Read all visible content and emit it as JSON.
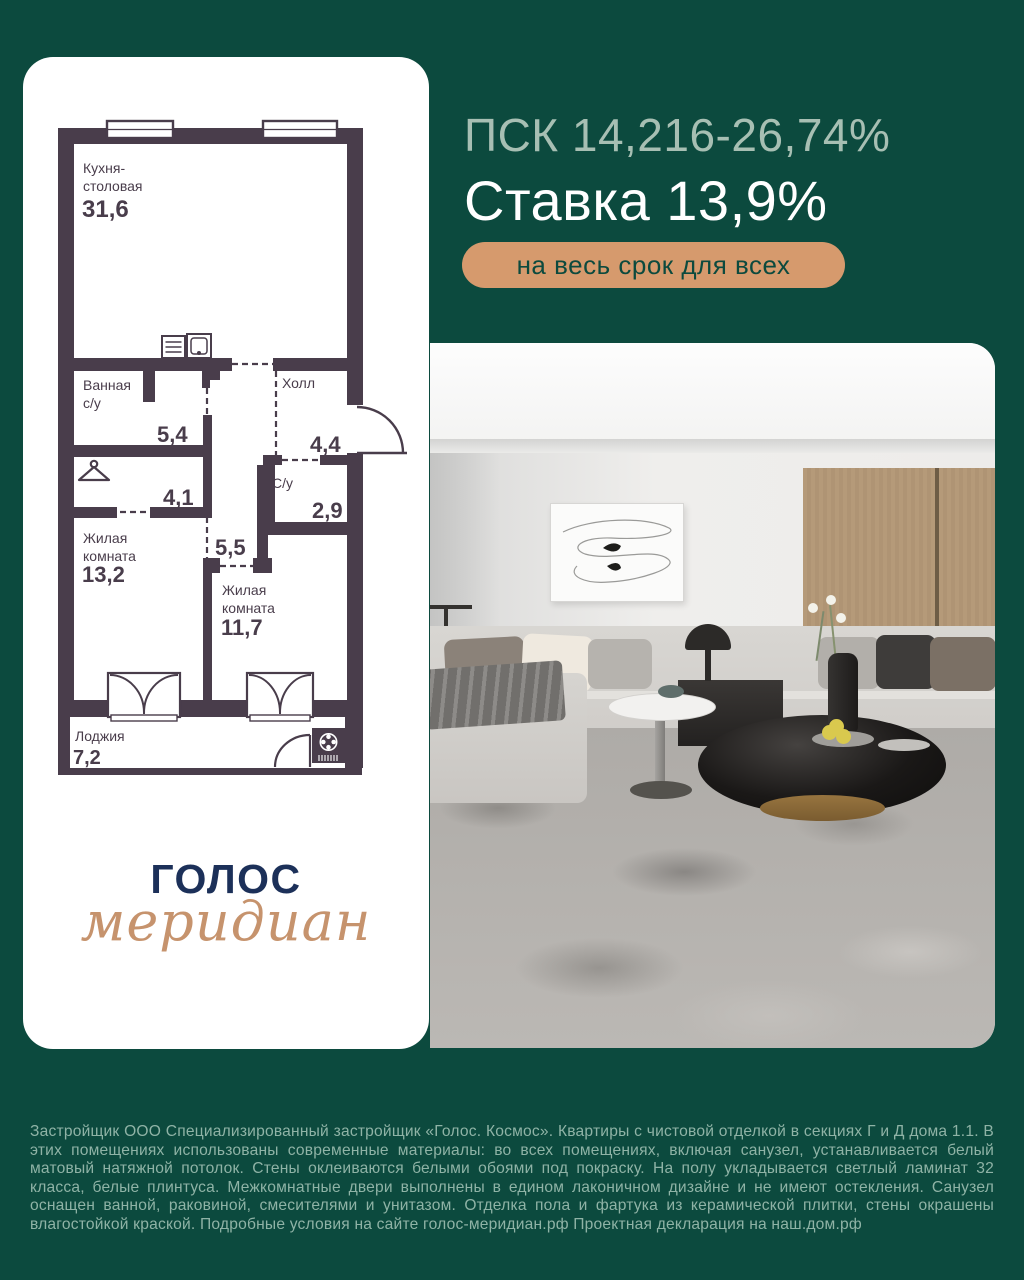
{
  "header": {
    "psk": "ПСК 14,216-26,74%",
    "rate": "Ставка 13,9%",
    "badge": "на весь срок для всех"
  },
  "floor_plan": {
    "kitchen_name_1": "Кухня-",
    "kitchen_name_2": "столовая",
    "kitchen_area": "31,6",
    "bath_name_1": "Ванная",
    "bath_name_2": "с/у",
    "bath_area": "5,4",
    "hall_name": "Холл",
    "hall_area": "4,4",
    "wardrobe_area": "4,1",
    "wc_name": "С/у",
    "wc_area": "2,9",
    "corridor_area": "5,5",
    "living1_name_1": "Жилая",
    "living1_name_2": "комната",
    "living1_area": "13,2",
    "living2_name_1": "Жилая",
    "living2_name_2": "комната",
    "living2_area": "11,7",
    "loggia_name": "Лоджия",
    "loggia_area": "7,2"
  },
  "logo": {
    "title": "ГОЛОС",
    "subtitle": "меридиан"
  },
  "footer": {
    "disclaimer": "Застройщик ООО Специализированный застройщик «Голос. Космос». Квартиры с чистовой отделкой в секциях Г и Д дома 1.1. В этих помещениях использованы современные материалы: во всех помещениях, включая санузел, устанавливается белый матовый натяжной потолок. Стены оклеиваются белыми обоями под покраску. На полу укладывается светлый ламинат 32 класса, белые плинтуса. Межкомнатные двери выполнены в едином лаконичном дизайне и не имеют остекления. Санузел оснащен ванной, раковиной, смесителями и унитазом. Отделка пола и фартука из керамической плитки, стены окрашены влагостойкой краской. Подробные условия на сайте голос-меридиан.рф Проектная декларация на наш.дом.рф"
  },
  "colors": {
    "background": "#0c4a3e",
    "badge": "#d69a6d",
    "plan_wall": "#493d4b",
    "headline_muted": "#a7bfb3",
    "logo_navy": "#1c3059",
    "logo_script": "#c6936d",
    "footer_text": "#8fb3a6"
  }
}
